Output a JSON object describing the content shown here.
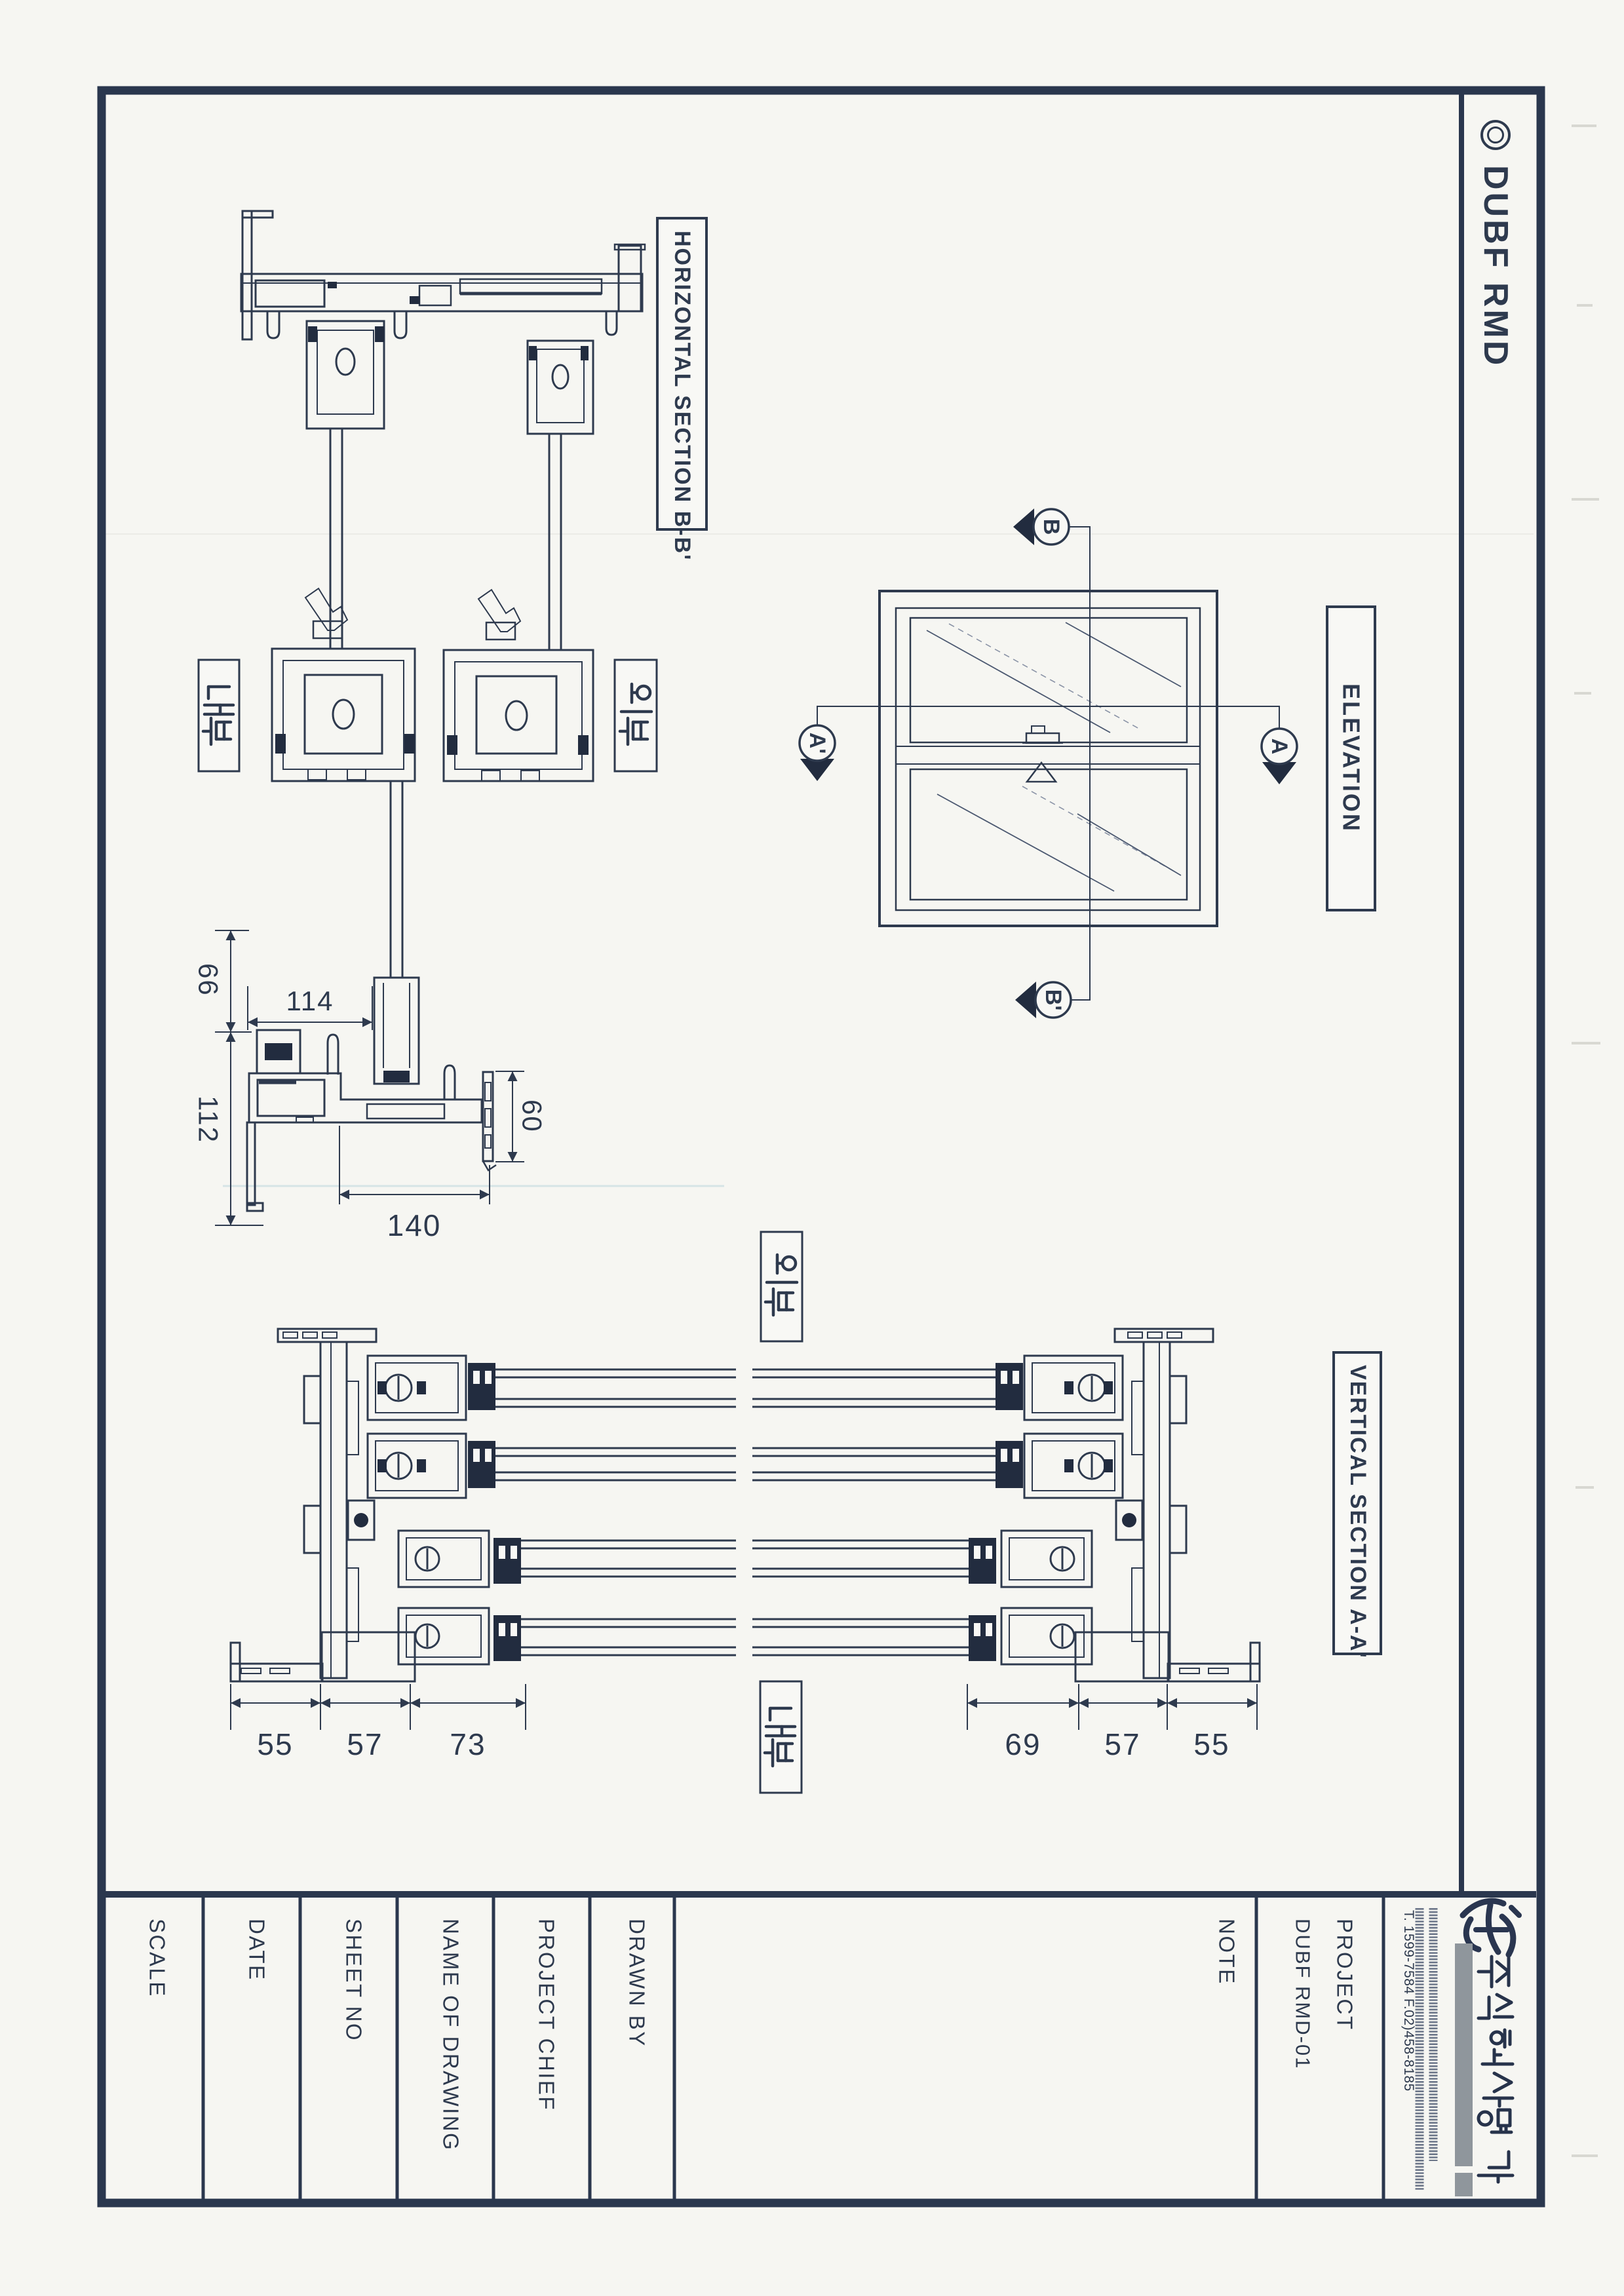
{
  "brand": {
    "symbol": "◎",
    "name": "DUBF RMD"
  },
  "section_labels": {
    "horizontal": "HORIZONTAL SECTION B-B'",
    "elevation": "ELEVATION",
    "vertical": "VERTICAL SECTION A-A'"
  },
  "side_labels": {
    "hs_interior": "내부",
    "hs_exterior": "외부",
    "vs_exterior": "외부",
    "vs_interior": "내부"
  },
  "section_markers": {
    "b": "B",
    "b_prime": "B'",
    "a": "A",
    "a_prime": "A'"
  },
  "dimensions": {
    "horizontal_section": {
      "left_top": "66",
      "left_bottom": "112",
      "sash_width": "114",
      "bottom_opening": "140",
      "frame_depth": "60"
    },
    "vertical_section_left": [
      "55",
      "57",
      "73"
    ],
    "vertical_section_right": [
      "69",
      "57",
      "55"
    ]
  },
  "title_block": {
    "scale_label": "SCALE",
    "date_label": "DATE",
    "sheet_no_label": "SHEET NO",
    "name_of_drawing_label": "NAME OF DRAWING",
    "project_chief_label": "PROJECT CHIEF",
    "drawn_by_label": "DRAWN BY",
    "note_label": "NOTE",
    "project_label": "PROJECT",
    "project_value": "DUBF RMD-01"
  },
  "stamp": {
    "company_name": "주식회사 명가",
    "factory_address": "공장: 충북 음성군 생극면 관성리 94",
    "seoul_office_address": "서울 사무소: 서울 광진구 중곡동 242-3 (2F)",
    "phone_fax": "T. 1599-7584  F.02)458-8185"
  },
  "colors": {
    "ink": "#2e3a4e",
    "border": "#2a374e",
    "paper": "#f8f8f5",
    "stamp_bar_gray": "#8f969c"
  }
}
